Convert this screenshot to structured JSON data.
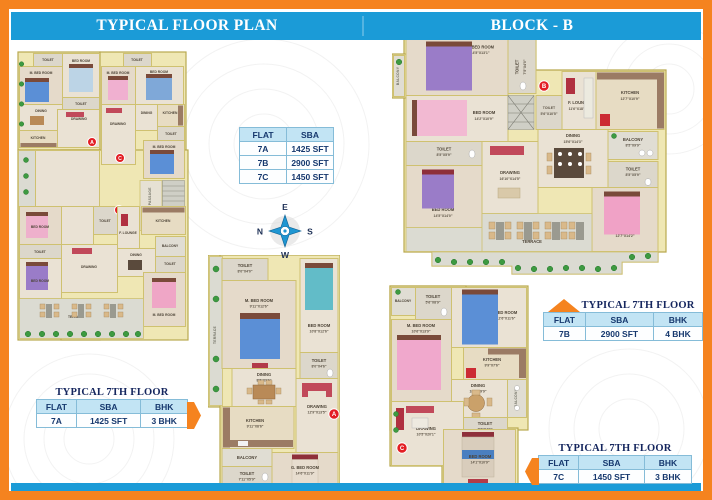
{
  "header": {
    "left_title": "TYPICAL FLOOR PLAN",
    "right_title": "BLOCK - B"
  },
  "colors": {
    "border_orange": "#f5831f",
    "bar_blue": "#1b9bd7",
    "table_header_blue": "#c2e4f4",
    "marker_red": "#e31e24"
  },
  "sba_table": {
    "headers": [
      "FLAT",
      "SBA"
    ],
    "rows": [
      {
        "flat": "7A",
        "sba": "1425 SFT"
      },
      {
        "flat": "7B",
        "sba": "2900 SFT"
      },
      {
        "flat": "7C",
        "sba": "1450 SFT"
      }
    ]
  },
  "floor_tables": [
    {
      "title": "TYPICAL 7TH FLOOR",
      "headers": [
        "FLAT",
        "SBA",
        "BHK"
      ],
      "flat": "7A",
      "sba": "1425 SFT",
      "bhk": "3 BHK"
    },
    {
      "title": "TYPICAL 7TH FLOOR",
      "headers": [
        "FLAT",
        "SBA",
        "BHK"
      ],
      "flat": "7B",
      "sba": "2900 SFT",
      "bhk": "4 BHK"
    },
    {
      "title": "TYPICAL 7TH FLOOR",
      "headers": [
        "FLAT",
        "SBA",
        "BHK"
      ],
      "flat": "7C",
      "sba": "1450 SFT",
      "bhk": "3 BHK"
    }
  ],
  "compass": {
    "e": "E",
    "s": "S",
    "w": "W",
    "n": "N"
  },
  "plans": {
    "composite": {
      "marker_a": "A",
      "marker_b": "B",
      "marker_c": "C",
      "passage": "7'7\" WIDE PASSAGE",
      "rooms": [
        "TOILET",
        "M. BED ROOM",
        "BED ROOM",
        "TOILET",
        "DINING",
        "KITCHEN",
        "DRAWING",
        "TOILET",
        "M. BED ROOM",
        "BED ROOM",
        "KITCHEN",
        "DINING",
        "DRAWING",
        "TOILET",
        "M. BED ROOM",
        "BED ROOM",
        "TOILET",
        "BED ROOM",
        "TOILET",
        "F. LOUNGE",
        "KITCHEN",
        "BALCONY",
        "DINING",
        "DRAWING",
        "TOILET",
        "M. BED ROOM",
        "TERRACE"
      ]
    },
    "flat_a": {
      "marker": "A",
      "rooms": [
        {
          "name": "TERRACE",
          "dim": ""
        },
        {
          "name": "TOILET",
          "dim": "8'0\"X4'0\""
        },
        {
          "name": "M. BED ROOM",
          "dim": "9'11\"X12'6\""
        },
        {
          "name": "BED ROOM",
          "dim": "10'8\"X12'6\""
        },
        {
          "name": "TOILET",
          "dim": "8'0\"X4'6\""
        },
        {
          "name": "DINING",
          "dim": "8'5\"X9'6\""
        },
        {
          "name": "KITCHEN",
          "dim": "9'11\"X8'6\""
        },
        {
          "name": "DRAWING",
          "dim": "12'9\"X13'5\""
        },
        {
          "name": "BALCONY",
          "dim": ""
        },
        {
          "name": "TOILET",
          "dim": "7'11\"X5'9\""
        },
        {
          "name": "G. BED ROOM",
          "dim": "14'6\"X11'9\""
        }
      ]
    },
    "flat_b": {
      "marker": "B",
      "rooms": [
        {
          "name": "BALCONY",
          "dim": ""
        },
        {
          "name": "M. BED ROOM",
          "dim": "14'5\"X13'1\""
        },
        {
          "name": "TOILET",
          "dim": "7'5\"X4'0\""
        },
        {
          "name": "BED ROOM",
          "dim": "14'2\"X10'9\""
        },
        {
          "name": "TOILET",
          "dim": "8'5\"X5'9\""
        },
        {
          "name": "TOILET",
          "dim": "5'6\"X10'5\""
        },
        {
          "name": "F. LOUNGE",
          "dim": "11'6\"X18'10\""
        },
        {
          "name": "KITCHEN",
          "dim": "12'7\"X10'9\""
        },
        {
          "name": "BALCONY",
          "dim": "8'5\"X9'9\""
        },
        {
          "name": "DINING",
          "dim": "15'6\"X14'3\""
        },
        {
          "name": "DRAWING",
          "dim": "16'10\"X14'5\""
        },
        {
          "name": "BED ROOM",
          "dim": "14'5\"X14'0\""
        },
        {
          "name": "TOILET",
          "dim": "8'5\"X5'9\""
        },
        {
          "name": "M. BED ROOM",
          "dim": "12'7\"X14'2\""
        },
        {
          "name": "TERRACE",
          "dim": ""
        }
      ]
    },
    "flat_c": {
      "marker": "C",
      "rooms": [
        {
          "name": "BALCONY",
          "dim": ""
        },
        {
          "name": "TOILET",
          "dim": "5'6\"X8'9\""
        },
        {
          "name": "M. BED ROOM",
          "dim": "10'6\"X13'9\""
        },
        {
          "name": "BED ROOM",
          "dim": "12'6\"X11'6\""
        },
        {
          "name": "KITCHEN",
          "dim": "9'9\"X7'6\""
        },
        {
          "name": "DINING",
          "dim": "10'5\"X9'9\""
        },
        {
          "name": "BALCONY",
          "dim": ""
        },
        {
          "name": "DRAWING",
          "dim": "10'5\"X20'1\""
        },
        {
          "name": "TOILET",
          "dim": "7'6\"X4'0\""
        },
        {
          "name": "BED ROOM",
          "dim": "14'1\"X10'9\""
        }
      ]
    }
  }
}
